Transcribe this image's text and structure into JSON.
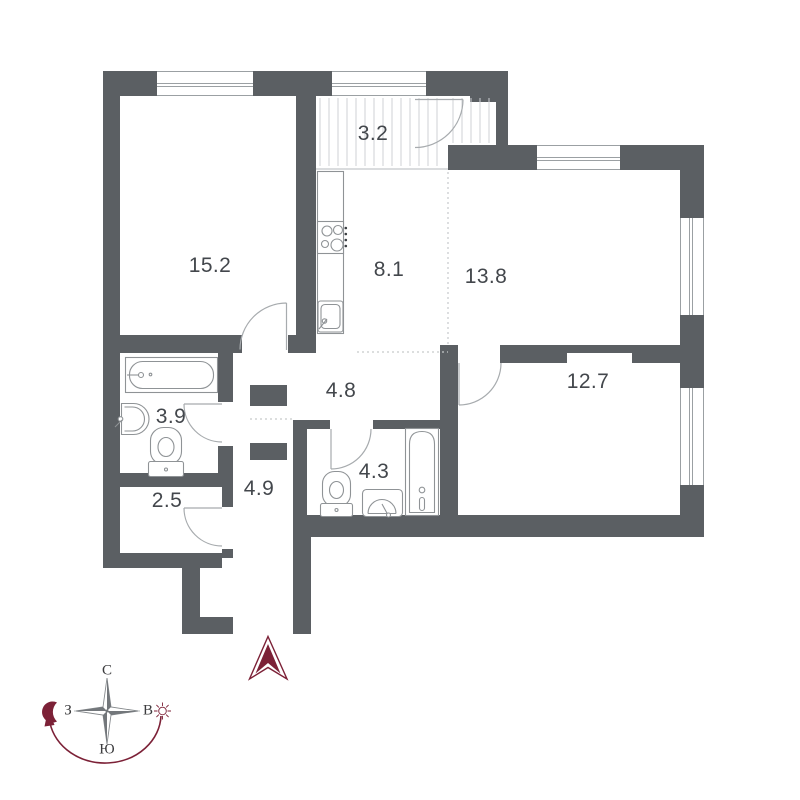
{
  "plan": {
    "title": "apartment-floor-plan",
    "rooms": [
      {
        "id": "living-room",
        "area": "15.2"
      },
      {
        "id": "loggia",
        "area": "3.2"
      },
      {
        "id": "kitchen",
        "area": "8.1"
      },
      {
        "id": "bedroom-top",
        "area": "13.8"
      },
      {
        "id": "bedroom-right",
        "area": "12.7"
      },
      {
        "id": "hall",
        "area": "4.8"
      },
      {
        "id": "bathroom-left",
        "area": "3.9"
      },
      {
        "id": "corridor",
        "area": "4.9"
      },
      {
        "id": "storage",
        "area": "2.5"
      },
      {
        "id": "bathroom-right",
        "area": "4.3"
      }
    ],
    "compass": {
      "north": "С",
      "south": "Ю",
      "west": "З",
      "east": "В"
    },
    "colors": {
      "wall": "#5b5f63",
      "accent": "#7c2137",
      "fixture_line": "#8f9396",
      "door_line": "#a7abae",
      "label": "#43474c"
    }
  }
}
